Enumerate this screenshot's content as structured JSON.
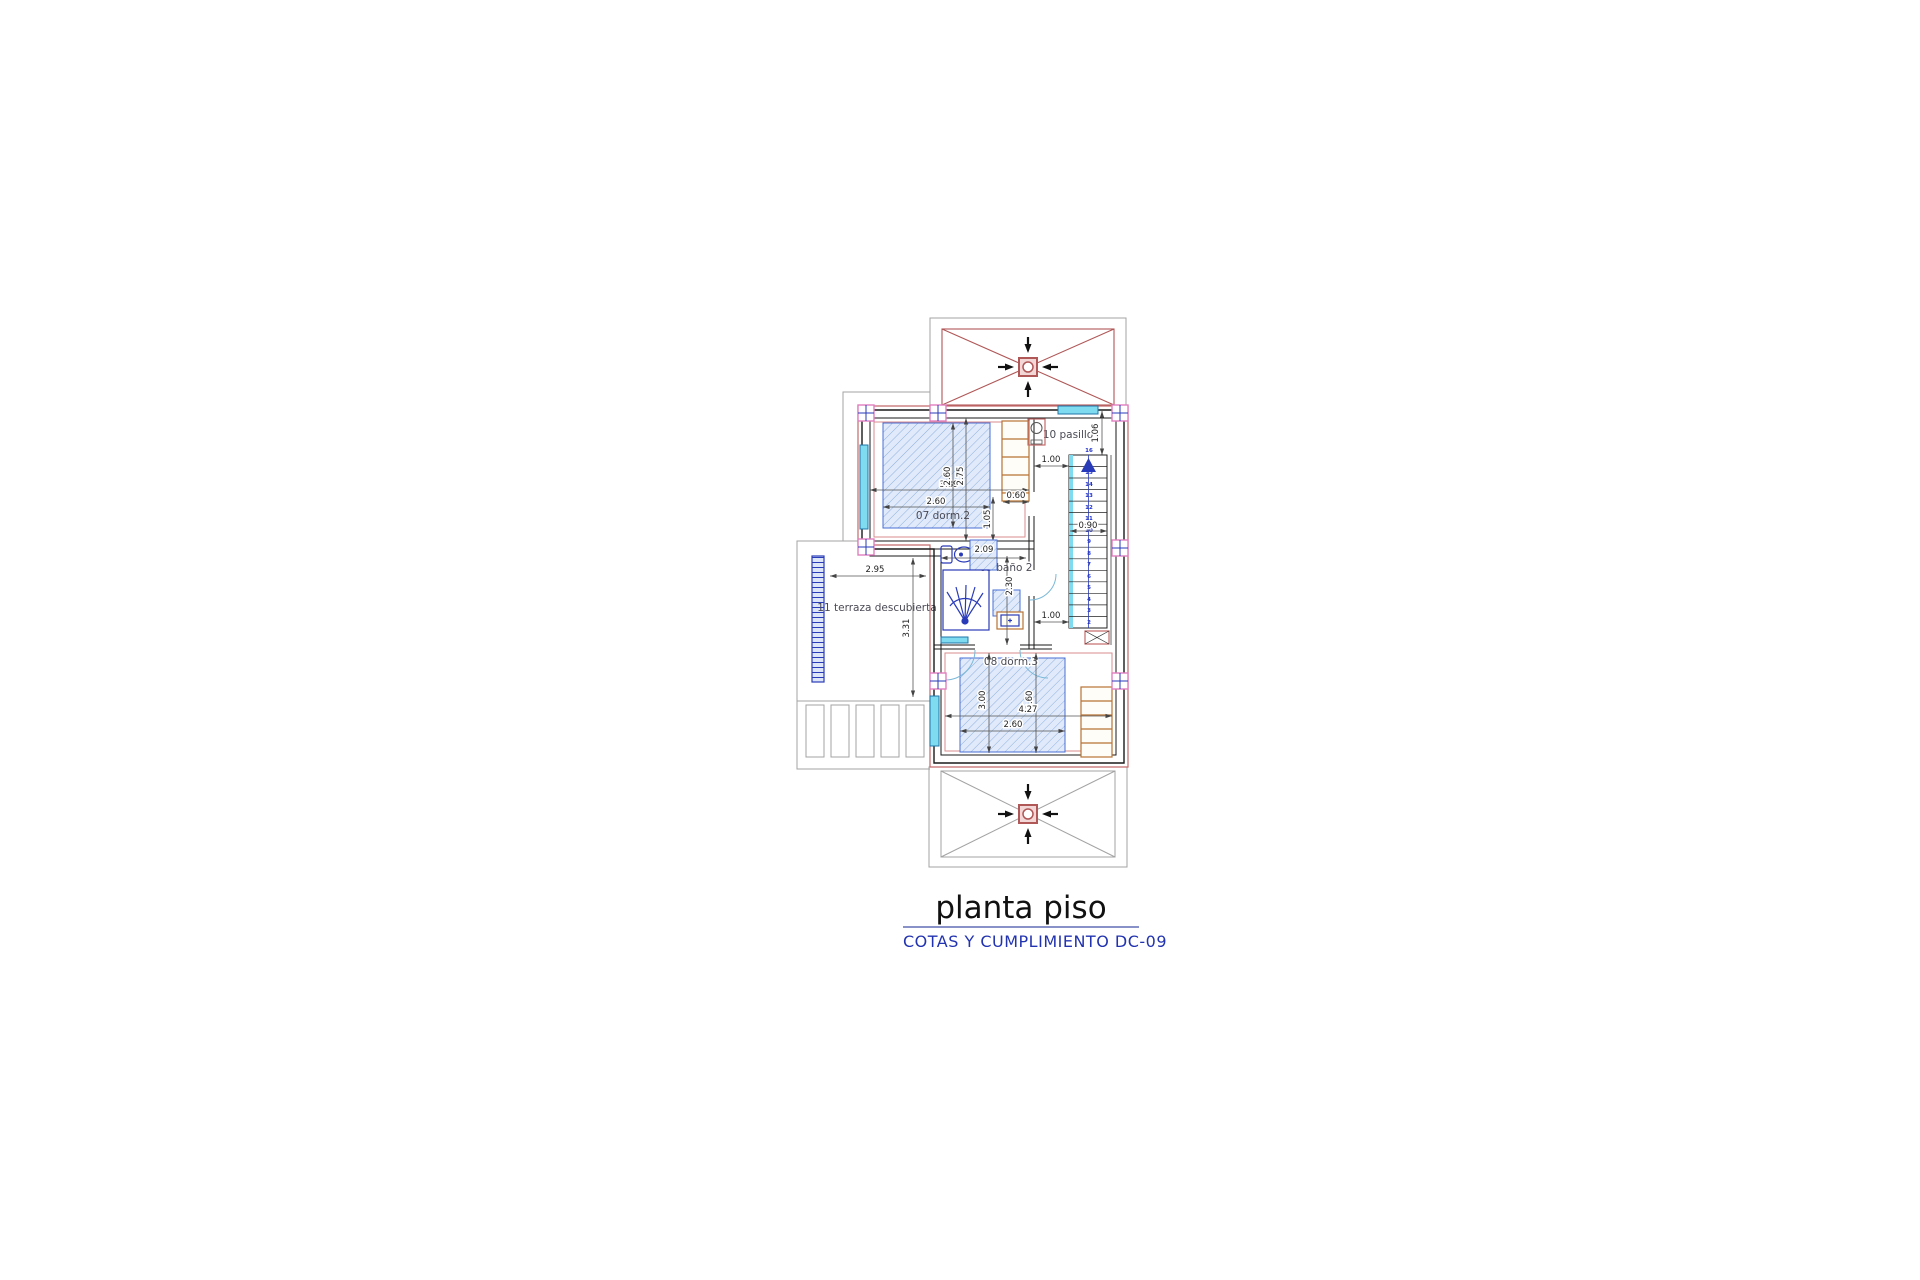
{
  "title": {
    "main": "planta piso",
    "subtitle": "COTAS Y CUMPLIMIENTO DC-09"
  },
  "rooms": {
    "dorm2": {
      "label": "07 dorm.2",
      "width_total": "3.89",
      "width_bed": "2.60",
      "height_bed": "2.60",
      "height_room": "2.75",
      "door_offset": "1.05",
      "door_width": "0.60"
    },
    "pasillo": {
      "label": "10 pasillo",
      "entry_depth": "1.06",
      "width_top": "1.00",
      "stair_width": "0.90",
      "width_bottom": "1.00"
    },
    "bano2": {
      "label": "09 baño 2",
      "width": "2.09",
      "height": "2.30"
    },
    "dorm3": {
      "label": "08 dorm.3",
      "height_room": "3.00",
      "height_bed": "2.60",
      "width_total": "4.27",
      "width_bed": "2.60"
    },
    "terraza": {
      "label": "11 terraza descubierta",
      "width": "2.95",
      "height": "3.31"
    }
  },
  "stairs": {
    "steps": [
      "16",
      "15",
      "14",
      "13",
      "12",
      "11",
      "10",
      "9",
      "8",
      "7",
      "6",
      "5",
      "4",
      "3",
      "2"
    ]
  },
  "colors": {
    "wall_accent": "#c46a6a",
    "column_marker": "#e07fc0",
    "fixture_blue": "#2a3bb8",
    "hatch_line": "#8fb0e0",
    "window_cyan": "#7fdbef",
    "wardrobe_tan": "#b87333",
    "roof_x_red": "#b05757",
    "outline_gray": "#a3a3a3",
    "subtitle_blue": "#2233b0"
  }
}
